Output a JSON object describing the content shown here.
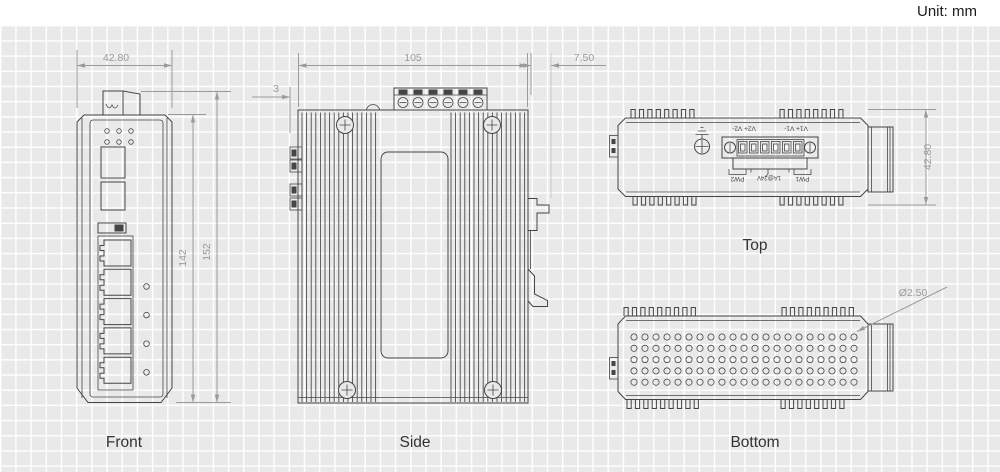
{
  "unit_label": "Unit: mm",
  "views": {
    "front": {
      "label": "Front",
      "dim_width": "42.80",
      "dim_body_height": "142",
      "dim_total_height": "152",
      "ports": 5,
      "status_led_rows": 2,
      "status_led_cols": 3,
      "port_leds": 4,
      "sfp_slots": 2
    },
    "side": {
      "label": "Side",
      "dim_width": "105",
      "dim_din_clip": "7.50",
      "dim_tab": "3",
      "terminal_screws": 6
    },
    "top": {
      "label": "Top",
      "dim_height": "42.80",
      "terminal": {
        "poles": 6,
        "labels_v1": "V1+ V1-",
        "labels_v2": "V2+ V2-",
        "pw1": "PW1",
        "pw2": "PW2",
        "rating": "1A@24V"
      }
    },
    "bottom": {
      "label": "Bottom",
      "hole_diameter": "Ø2.50",
      "hole_rows": 5,
      "hole_cols": 21
    }
  },
  "style": {
    "line_color": "#454545",
    "dim_color": "#9a9a9a",
    "grid_bg": "#e9e9e9",
    "grid_line": "#ffffff",
    "label_color": "#333333"
  }
}
